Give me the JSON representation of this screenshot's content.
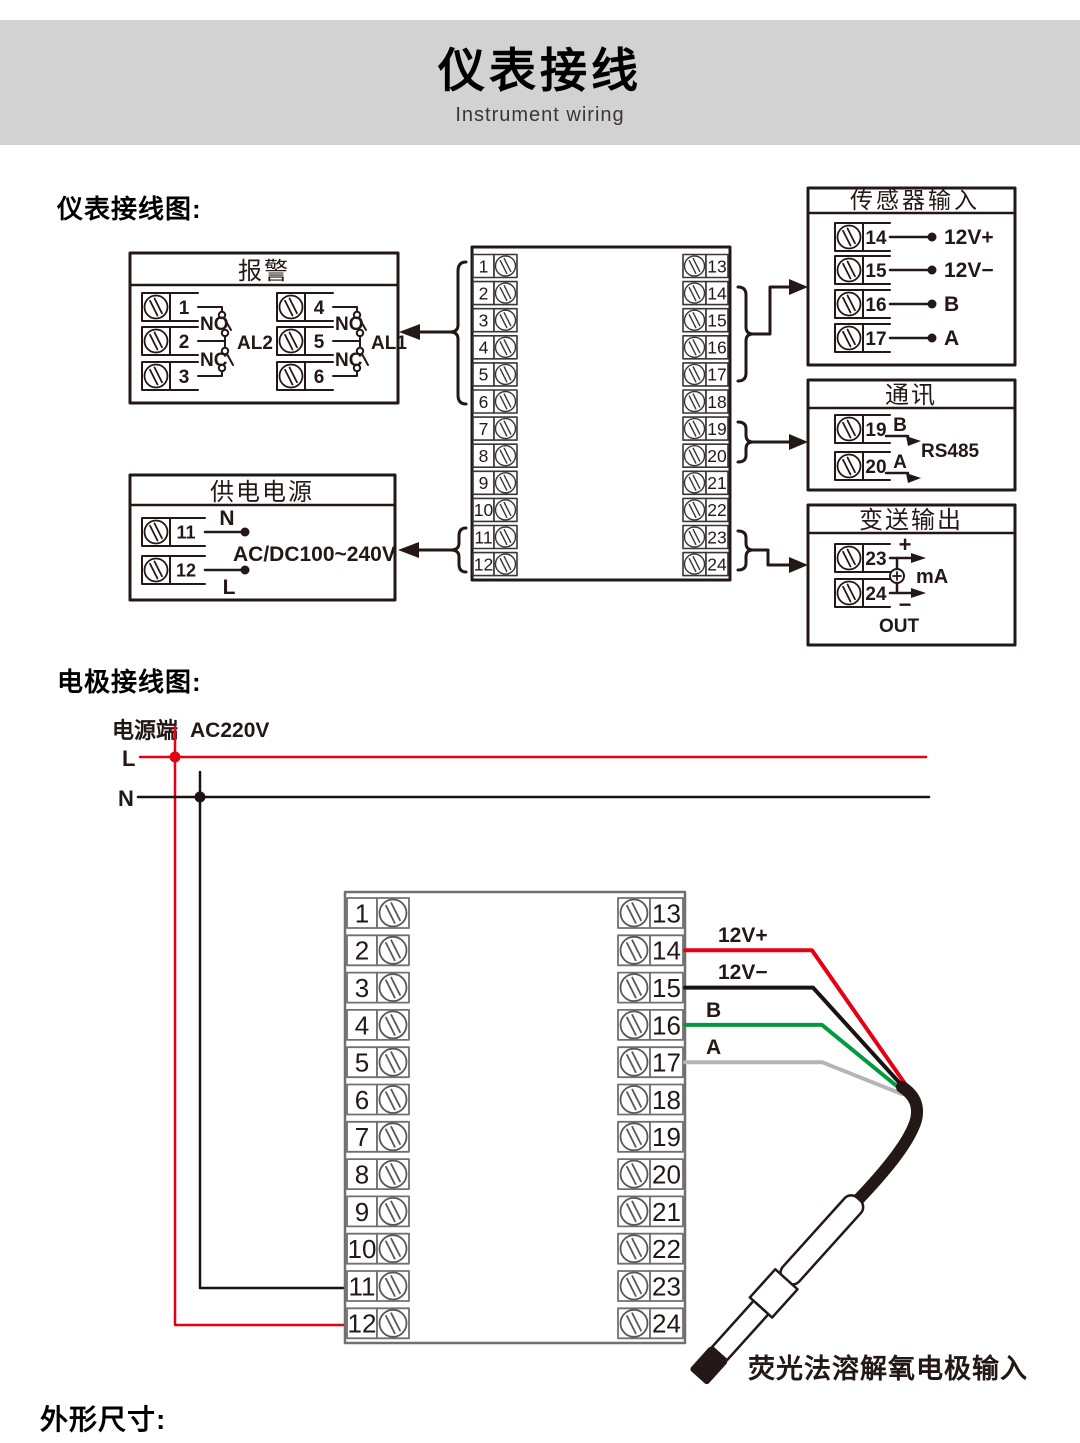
{
  "header": {
    "title": "仪表接线",
    "subtitle": "Instrument wiring"
  },
  "section_labels": {
    "instrument": "仪表接线图:",
    "electrode": "电极接线图:",
    "dimensions": "外形尺寸:"
  },
  "instrument_diagram": {
    "alarm": {
      "title": "报警",
      "groups": [
        {
          "terminals": [
            "1",
            "2",
            "3"
          ],
          "no_label": "NO",
          "nc_label": "NC",
          "relay_label": "AL2"
        },
        {
          "terminals": [
            "4",
            "5",
            "6"
          ],
          "no_label": "NO",
          "nc_label": "NC",
          "relay_label": "AL1"
        }
      ]
    },
    "power": {
      "title": "供电电源",
      "terminals": [
        "11",
        "12"
      ],
      "neutral_label": "N",
      "live_label": "L",
      "voltage_label": "AC/DC100~240V"
    },
    "terminal_block": {
      "left": [
        "1",
        "2",
        "3",
        "4",
        "5",
        "6",
        "7",
        "8",
        "9",
        "10",
        "11",
        "12"
      ],
      "right": [
        "13",
        "14",
        "15",
        "16",
        "17",
        "18",
        "19",
        "20",
        "21",
        "22",
        "23",
        "24"
      ]
    },
    "sensor": {
      "title": "传感器输入",
      "rows": [
        {
          "terminal": "14",
          "label": "12V+"
        },
        {
          "terminal": "15",
          "label": "12V−"
        },
        {
          "terminal": "16",
          "label": "B"
        },
        {
          "terminal": "17",
          "label": "A"
        }
      ]
    },
    "comm": {
      "title": "通讯",
      "rows": [
        {
          "terminal": "19",
          "label": "B"
        },
        {
          "terminal": "20",
          "label": "A"
        }
      ],
      "protocol_label": "RS485"
    },
    "transmit": {
      "title": "变送输出",
      "terminals": [
        "23",
        "24"
      ],
      "plus_label": "+",
      "minus_label": "−",
      "unit_label": "mA",
      "out_label": "OUT"
    }
  },
  "electrode_diagram": {
    "power_end_label": "电源端",
    "voltage_label": "AC220V",
    "live_label": "L",
    "neutral_label": "N",
    "terminal_block": {
      "left": [
        "1",
        "2",
        "3",
        "4",
        "5",
        "6",
        "7",
        "8",
        "9",
        "10",
        "11",
        "12"
      ],
      "right": [
        "13",
        "14",
        "15",
        "16",
        "17",
        "18",
        "19",
        "20",
        "21",
        "22",
        "23",
        "24"
      ]
    },
    "wires": [
      {
        "terminal": "14",
        "label": "12V+",
        "color": "#e60012"
      },
      {
        "terminal": "15",
        "label": "12V−",
        "color": "#1a1311"
      },
      {
        "terminal": "16",
        "label": "B",
        "color": "#009b3c"
      },
      {
        "terminal": "17",
        "label": "A",
        "color": "#b5b5b6"
      }
    ],
    "probe_label": "荧光法溶解氧电极输入"
  },
  "colors": {
    "accent_red": "#e60012",
    "wire_black": "#1a1311",
    "wire_green": "#009b3c",
    "wire_gray": "#b5b5b6",
    "ink": "#231815",
    "block_gray": "#717071",
    "header_bg": "#d2d2d3"
  }
}
